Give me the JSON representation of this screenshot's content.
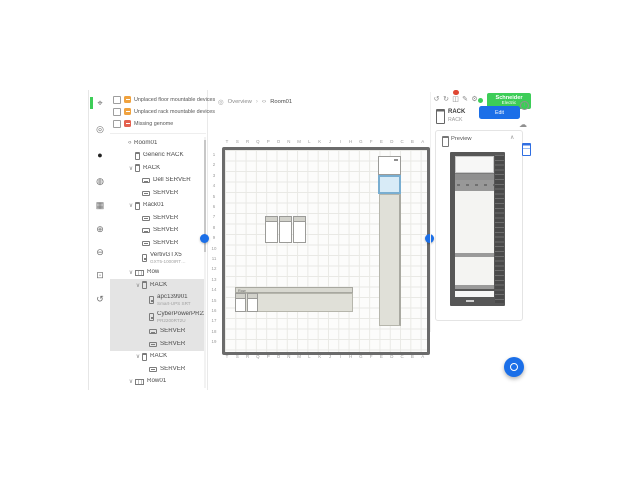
{
  "brand": {
    "line1": "Schneider",
    "line2": "Electric",
    "green": "#3DCD58"
  },
  "accent": {
    "blue": "#1B6FE8",
    "selection_blue": "#79AED1",
    "alert_red": "#DF4733"
  },
  "left_toolbar": {
    "tools": [
      {
        "name": "layout-tool",
        "glyph": "⌖",
        "active": true
      },
      {
        "name": "pan-tool",
        "glyph": "◎",
        "active": false
      },
      {
        "name": "record-tool",
        "glyph": "●",
        "active": false
      },
      {
        "name": "capacity-tool",
        "glyph": "◍",
        "active": false
      },
      {
        "name": "grid-tool",
        "glyph": "▦",
        "active": false
      },
      {
        "name": "zoom-in-tool",
        "glyph": "⊕",
        "active": false
      },
      {
        "name": "zoom-out-tool",
        "glyph": "⊖",
        "active": false
      },
      {
        "name": "zoom-fit-tool",
        "glyph": "⊡",
        "active": false
      },
      {
        "name": "history-tool",
        "glyph": "↺",
        "active": false
      }
    ]
  },
  "filters": [
    {
      "label": "Unplaced floor mountable devices",
      "color": "#F0A23E",
      "checked": false
    },
    {
      "label": "Unplaced rack mountable devices",
      "color": "#F0A23E",
      "checked": false
    },
    {
      "label": "Missing genome",
      "color": "#E4604E",
      "checked": false
    }
  ],
  "tree": [
    {
      "label": "Room01",
      "depth": 0,
      "icon": "room",
      "chevron": false,
      "selected": false
    },
    {
      "label": "Generic RACK",
      "depth": 1,
      "icon": "rack",
      "chevron": false,
      "selected": false
    },
    {
      "label": "RACK",
      "depth": 1,
      "icon": "rack",
      "chevron": true,
      "selected": false
    },
    {
      "label": "Dell SERVER",
      "depth": 2,
      "icon": "server",
      "chevron": false,
      "selected": false
    },
    {
      "label": "SERVER",
      "depth": 2,
      "icon": "server",
      "chevron": false,
      "selected": false
    },
    {
      "label": "Rack01",
      "depth": 1,
      "icon": "rack",
      "chevron": true,
      "selected": false
    },
    {
      "label": "SERVER",
      "depth": 2,
      "icon": "server",
      "chevron": false,
      "selected": false
    },
    {
      "label": "SERVER",
      "depth": 2,
      "icon": "server",
      "chevron": false,
      "selected": false
    },
    {
      "label": "SERVER",
      "depth": 2,
      "icon": "server",
      "chevron": false,
      "selected": false
    },
    {
      "label": "VertivGTX5",
      "sublabel": "GXT5-1000IRT…",
      "depth": 2,
      "icon": "ups",
      "chevron": false,
      "selected": false
    },
    {
      "label": "Row",
      "depth": 1,
      "icon": "row",
      "chevron": true,
      "selected": false
    },
    {
      "label": "RACK",
      "depth": 2,
      "icon": "rack",
      "chevron": true,
      "selected": true
    },
    {
      "label": "apc139901",
      "sublabel": "Smart-UPS SRT",
      "depth": 3,
      "icon": "ups",
      "chevron": false,
      "selected": true
    },
    {
      "label": "CyberPowerPR2200R…",
      "sublabel": "PR2200RT2U",
      "depth": 3,
      "icon": "ups",
      "chevron": false,
      "selected": true
    },
    {
      "label": "SERVER",
      "depth": 3,
      "icon": "server",
      "chevron": false,
      "selected": true
    },
    {
      "label": "SERVER",
      "depth": 3,
      "icon": "server",
      "chevron": false,
      "selected": true
    },
    {
      "label": "RACK",
      "depth": 2,
      "icon": "rack",
      "chevron": true,
      "selected": false
    },
    {
      "label": "SERVER",
      "depth": 3,
      "icon": "server",
      "chevron": false,
      "selected": false
    },
    {
      "label": "Row01",
      "depth": 1,
      "icon": "row",
      "chevron": true,
      "selected": false
    }
  ],
  "breadcrumb": {
    "overview": "Overview",
    "separator": "›",
    "room": "Room01"
  },
  "canvas": {
    "top_letters": [
      "T",
      "S",
      "R",
      "Q",
      "P",
      "O",
      "N",
      "M",
      "L",
      "K",
      "J",
      "I",
      "H",
      "G",
      "F",
      "E",
      "D",
      "C",
      "B",
      "A"
    ],
    "bottom_letters": [
      "T",
      "S",
      "R",
      "Q",
      "P",
      "O",
      "N",
      "M",
      "L",
      "K",
      "J",
      "I",
      "H",
      "G",
      "F",
      "E",
      "D",
      "C",
      "B",
      "A"
    ],
    "left_numbers": [
      "1",
      "2",
      "3",
      "4",
      "5",
      "6",
      "7",
      "8",
      "9",
      "10",
      "11",
      "12",
      "13",
      "14",
      "15",
      "16",
      "17",
      "18",
      "19"
    ],
    "row_label": "Row"
  },
  "inspector": {
    "icons": [
      {
        "name": "undo-icon",
        "glyph": "↺",
        "badge": false
      },
      {
        "name": "redo-icon",
        "glyph": "↻",
        "badge": false
      },
      {
        "name": "alerts-icon",
        "glyph": "◫",
        "badge": true
      },
      {
        "name": "edit-icon",
        "glyph": "✎",
        "badge": false
      },
      {
        "name": "settings-icon",
        "glyph": "⚙",
        "badge": false
      }
    ],
    "selected_type": "RACK",
    "selected_name": "RACK",
    "edit_button": "Edit Properties",
    "preview_title": "Preview",
    "collapse_glyph": "∧"
  },
  "right_rail": {
    "info_glyph": "i",
    "cloud_glyph": "☁"
  }
}
